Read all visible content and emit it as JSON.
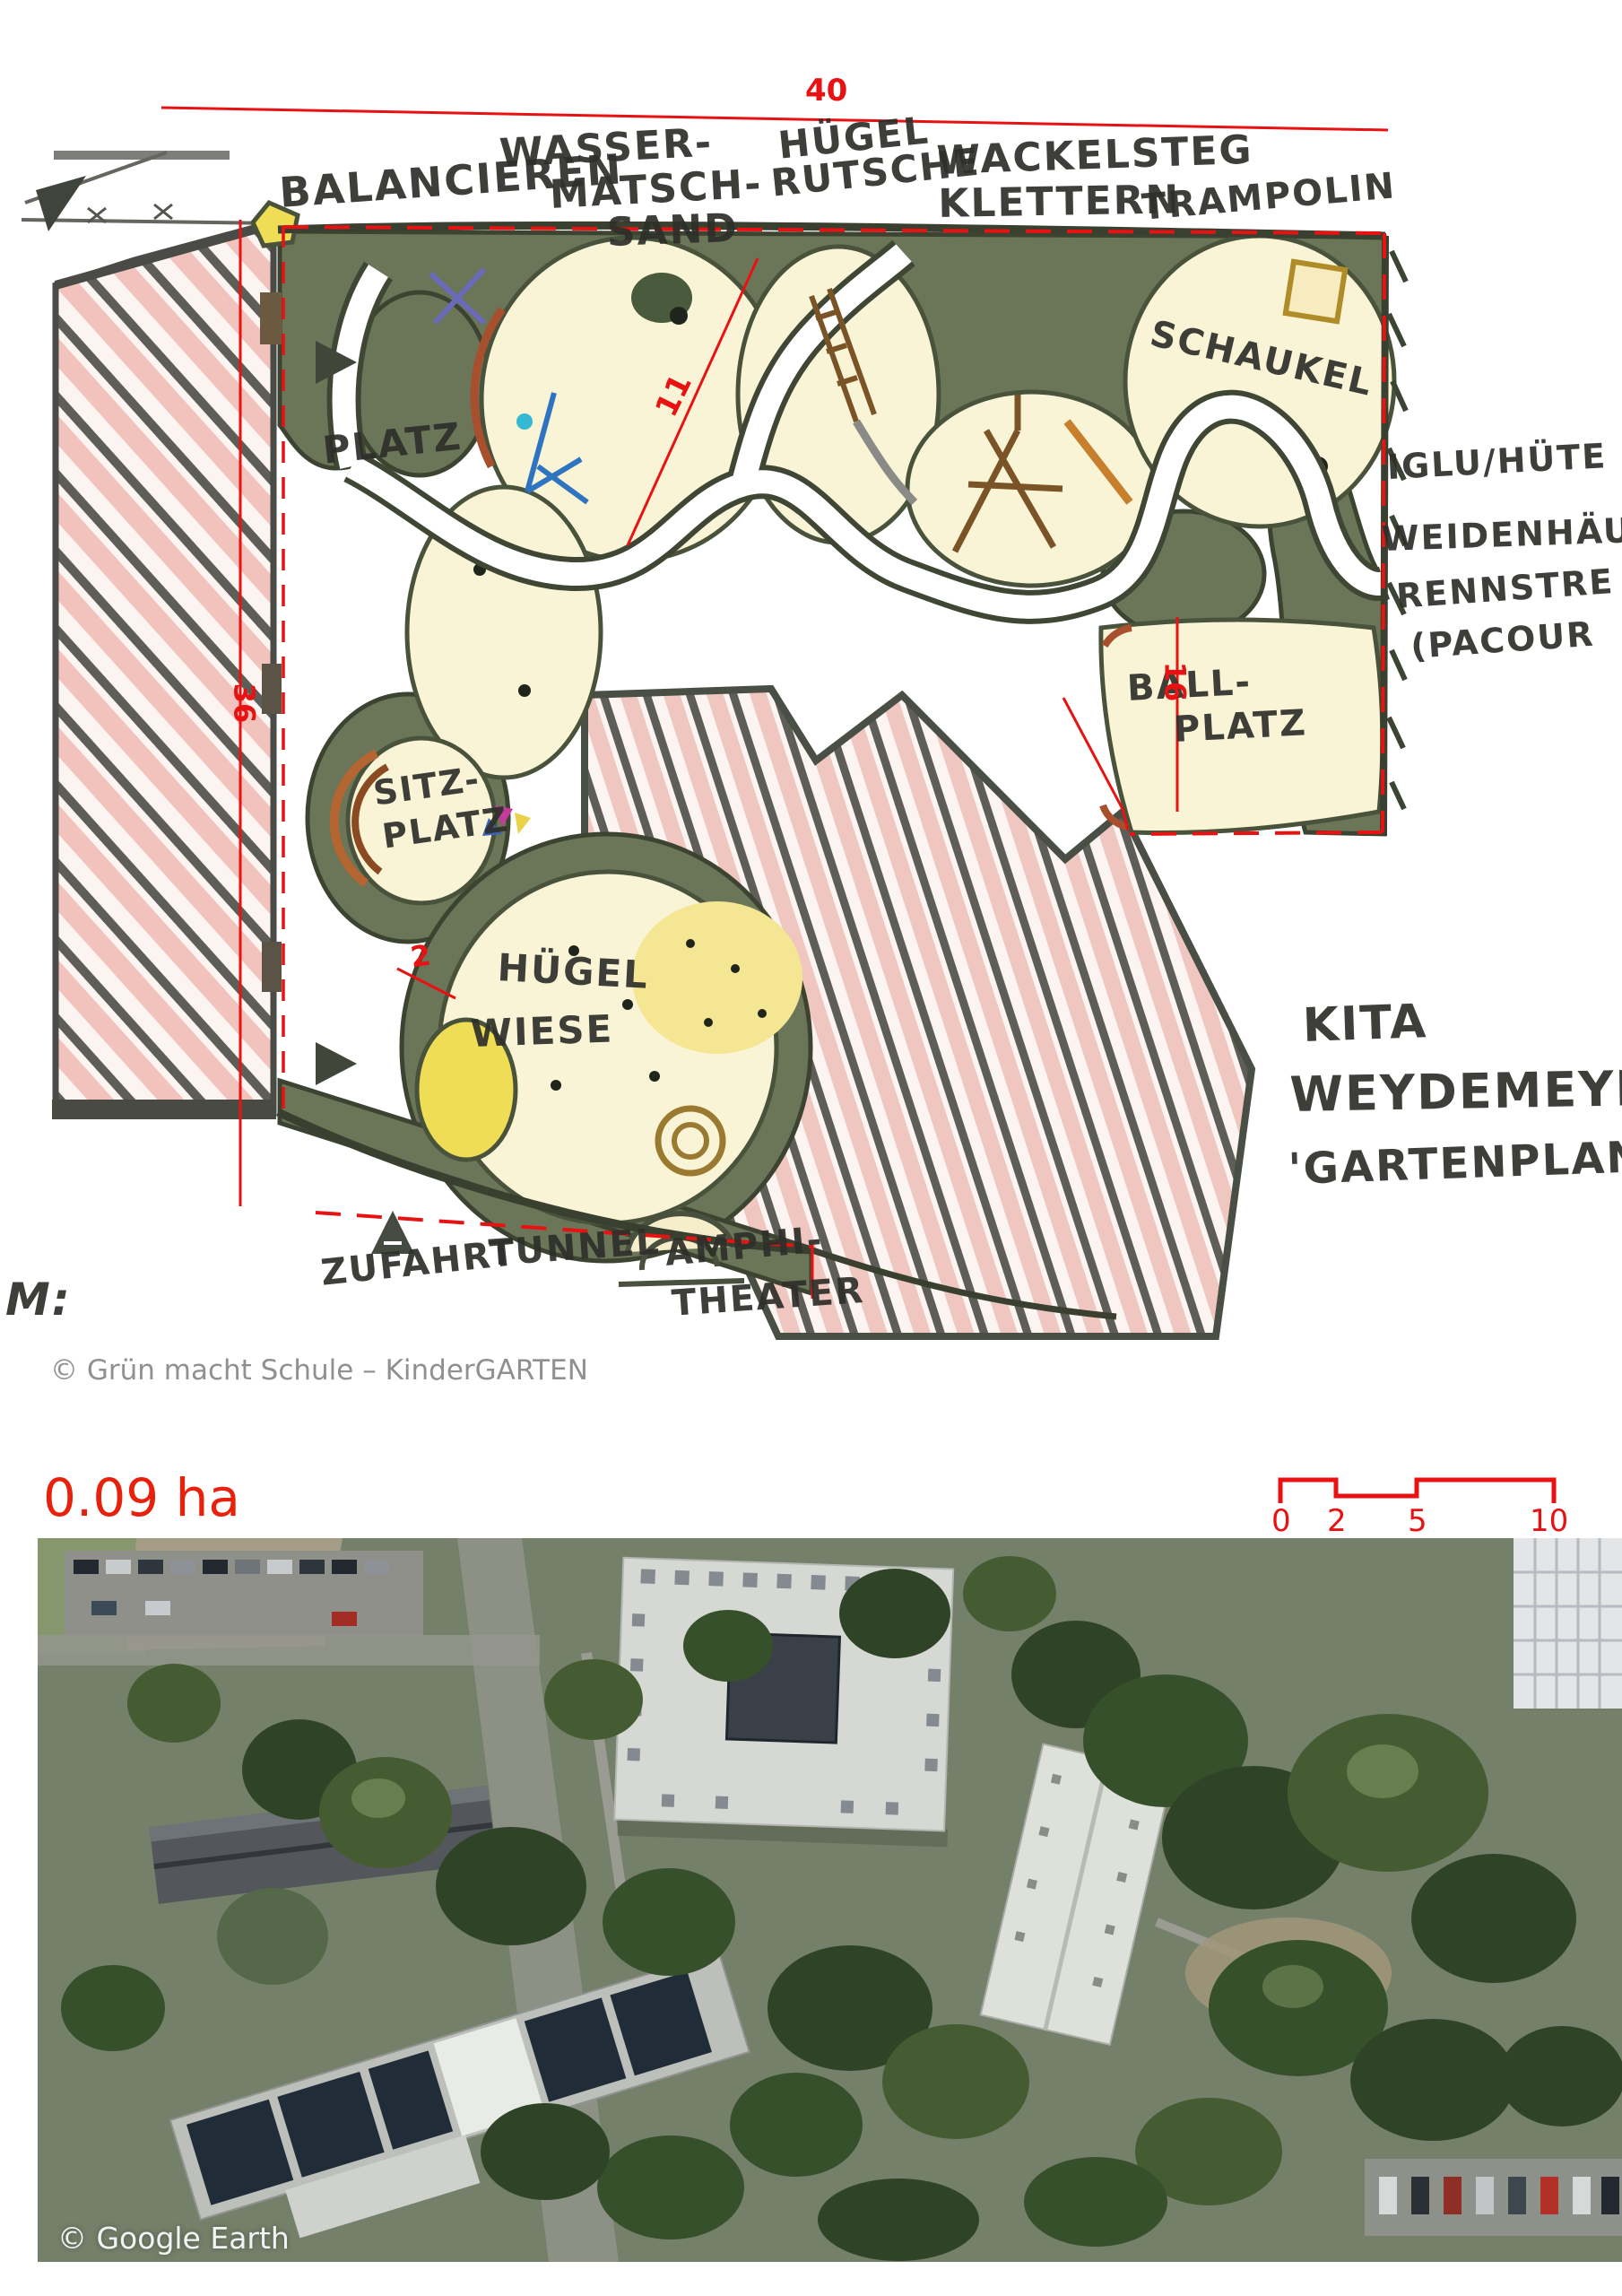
{
  "plan": {
    "labels": {
      "balancieren": "BALANCIEREN",
      "wasser_1": "WASSER-",
      "wasser_2": "MATSCH-",
      "wasser_3": "SAND",
      "huegel_rutsche_1": "HÜGEL",
      "huegel_rutsche_2": "RUTSCHE",
      "wackelsteg": "WACKELSTEG",
      "klettern": "KLETTERN",
      "trampolin": "TRAMPOLIN",
      "schaukel": "SCHAUKEL",
      "platz": "PLATZ",
      "sitzplatz_1": "SITZ-",
      "sitzplatz_2": "PLATZ",
      "huegel": "HÜGEL",
      "wiese": "WIESE",
      "ballplatz_1": "BALL-",
      "ballplatz_2": "PLATZ",
      "iglu_huette": "IGLU/HÜTE",
      "weidenhaus": "WEIDENHÄU",
      "rennstrecke": "RENNSTRE",
      "parcour": "(PACOUR",
      "kita": "KITA",
      "weydemeyer": "WEYDEMEYE",
      "gartenplanung": "'GARTENPLANU",
      "zufahrt": "ZUFAHRT",
      "tunnel": "TUNNEL",
      "amphi_1": "AMPHI-",
      "amphi_2": "THEATER",
      "m_label": "M:"
    },
    "dimensions": {
      "width_top": "40",
      "height_left": "36",
      "diagonal": "11",
      "ball_height": "16",
      "path_width": "2"
    }
  },
  "plan_credit": "© Grün macht Schule – KinderGARTEN",
  "area_label": "0.09 ha",
  "scale_bar": {
    "ticks": [
      "0",
      "2",
      "5",
      "10"
    ]
  },
  "photo_credit": "© Google Earth",
  "colors": {
    "dimension_red": "#e81212",
    "area_red": "#e8210c",
    "plan_credit_gray": "#909090",
    "photo_credit_white": "#f2f3f4",
    "vegetation_green": "#6b7558",
    "mound_cream": "#faf4d6",
    "hatch_pink": "#f2c3bc"
  }
}
